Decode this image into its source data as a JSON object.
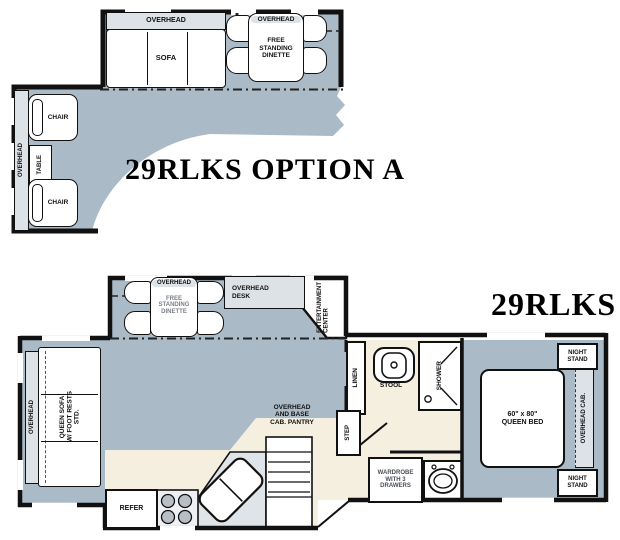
{
  "plan_a": {
    "title": "29RLKS OPTION A",
    "slide": {
      "overhead": "OVERHEAD",
      "sofa": "SOFA",
      "dinette_overhead": "OVERHEAD",
      "dinette": "FREE\nSTANDING\nDINETTE"
    },
    "left": {
      "overhead": "OVERHEAD",
      "chair_top": "CHAIR",
      "table": "TABLE",
      "chair_bottom": "CHAIR"
    }
  },
  "plan_b": {
    "title": "29RLKS",
    "slide": {
      "dinette_overhead": "OVERHEAD",
      "dinette": "FREE\nSTANDING\nDINETTE",
      "desk": "OVERHEAD\nDESK",
      "entertainment": "ENTERTAINMENT\nCENTER"
    },
    "living": {
      "overhead": "OVERHEAD",
      "queen_sofa": "QUEEN SOFA\nW/ FOOT RESTS\nSTD."
    },
    "bath": {
      "linen": "LINEN",
      "stool": "STOOL",
      "shower": "SHOWER"
    },
    "kitchen": {
      "pantry": "OVERHEAD\nAND BASE\nCAB. PANTRY",
      "refer": "REFER",
      "step": "STEP",
      "wardrobe": "WARDROBE\nWITH 3\nDRAWERS"
    },
    "bedroom": {
      "bed": "60\" x 80\"\nQUEEN BED",
      "overhead_cab": "OVERHEAD CAB.",
      "night_stand_top": "NIGHT\nSTAND",
      "night_stand_bottom": "NIGHT\nSTAND"
    }
  },
  "colors": {
    "floor": "#abbac7",
    "cabinet": "#dde2e7",
    "beige": "#f4efde",
    "wall": "#111111",
    "furniture": "#ffffff"
  }
}
